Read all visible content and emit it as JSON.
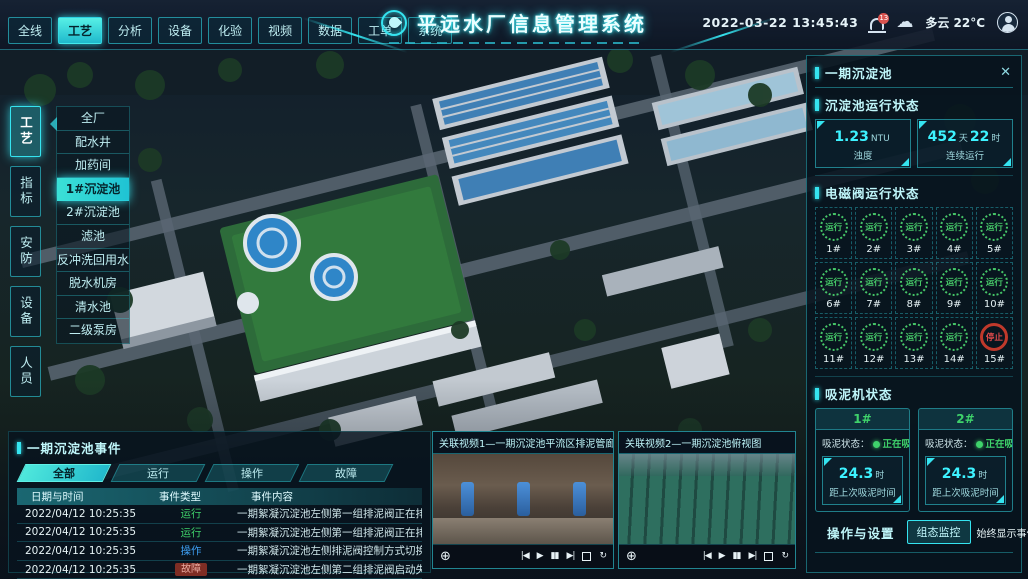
{
  "app": {
    "title": "平远水厂信息管理系统"
  },
  "header": {
    "tabs": [
      {
        "label": "全线",
        "active": false
      },
      {
        "label": "工艺",
        "active": true
      },
      {
        "label": "分析",
        "active": false
      },
      {
        "label": "设备",
        "active": false
      },
      {
        "label": "化验",
        "active": false
      },
      {
        "label": "视频",
        "active": false
      },
      {
        "label": "数据",
        "active": false
      },
      {
        "label": "工单",
        "active": false
      },
      {
        "label": "系统",
        "active": false
      }
    ],
    "datetime": "2022-03-22 13:45:43",
    "notif_count": "13",
    "cloud_icon": "☁",
    "weather": "多云 22°C"
  },
  "side_tabs": [
    {
      "label": "工艺",
      "active": true
    },
    {
      "label": "指标",
      "active": false
    },
    {
      "label": "安防",
      "active": false
    },
    {
      "label": "设备",
      "active": false
    },
    {
      "label": "人员",
      "active": false
    }
  ],
  "process_menu": [
    {
      "label": "全厂",
      "active": false
    },
    {
      "label": "配水井",
      "active": false
    },
    {
      "label": "加药间",
      "active": false
    },
    {
      "label": "1#沉淀池",
      "active": true
    },
    {
      "label": "2#沉淀池",
      "active": false
    },
    {
      "label": "滤池",
      "active": false
    },
    {
      "label": "反冲洗回用水池",
      "active": false
    },
    {
      "label": "脱水机房",
      "active": false
    },
    {
      "label": "清水池",
      "active": false
    },
    {
      "label": "二级泵房",
      "active": false
    }
  ],
  "right_panel": {
    "title": "一期沉淀池",
    "close_icon": "✕",
    "run_status": {
      "title": "沉淀池运行状态",
      "stats": [
        {
          "parts": [
            [
              "1.23",
              "num"
            ],
            [
              "NTU",
              "unit"
            ]
          ],
          "label": "浊度"
        },
        {
          "parts": [
            [
              "452",
              "num"
            ],
            [
              "天",
              "unit"
            ],
            [
              "22",
              "num"
            ],
            [
              "时",
              "unit"
            ]
          ],
          "label": "连续运行"
        }
      ]
    },
    "valves": {
      "title": "电磁阀运行状态",
      "items": [
        {
          "id": "1#",
          "status": "运行",
          "state": "run"
        },
        {
          "id": "2#",
          "status": "运行",
          "state": "run"
        },
        {
          "id": "3#",
          "status": "运行",
          "state": "run"
        },
        {
          "id": "4#",
          "status": "运行",
          "state": "run"
        },
        {
          "id": "5#",
          "status": "运行",
          "state": "run"
        },
        {
          "id": "6#",
          "status": "运行",
          "state": "run"
        },
        {
          "id": "7#",
          "status": "运行",
          "state": "run"
        },
        {
          "id": "8#",
          "status": "运行",
          "state": "run"
        },
        {
          "id": "9#",
          "status": "运行",
          "state": "run"
        },
        {
          "id": "10#",
          "status": "运行",
          "state": "run"
        },
        {
          "id": "11#",
          "status": "运行",
          "state": "run"
        },
        {
          "id": "12#",
          "status": "运行",
          "state": "run"
        },
        {
          "id": "13#",
          "status": "运行",
          "state": "run"
        },
        {
          "id": "14#",
          "status": "运行",
          "state": "run"
        },
        {
          "id": "15#",
          "status": "停止",
          "state": "stop"
        }
      ]
    },
    "suckers": {
      "title": "吸泥机状态",
      "status_label": "吸泥状态：",
      "cards": [
        {
          "id": "1#",
          "status": "正在吸泥",
          "stat": {
            "parts": [
              [
                "24.3",
                "num"
              ],
              [
                "时",
                "unit"
              ]
            ],
            "label": "距上次吸泥时间"
          }
        },
        {
          "id": "2#",
          "status": "正在吸泥",
          "stat": {
            "parts": [
              [
                "24.3",
                "num"
              ],
              [
                "时",
                "unit"
              ]
            ],
            "label": "距上次吸泥时间"
          }
        }
      ]
    },
    "ops": {
      "title": "操作与设置",
      "button": "组态监控",
      "toggle_label": "始终显示事件：",
      "toggle_on": true
    }
  },
  "events": {
    "title": "一期沉淀池事件",
    "tabs": [
      {
        "label": "全部",
        "active": true
      },
      {
        "label": "运行",
        "active": false
      },
      {
        "label": "操作",
        "active": false
      },
      {
        "label": "故障",
        "active": false
      }
    ],
    "columns": [
      "日期与时间",
      "事件类型",
      "事件内容"
    ],
    "rows": [
      {
        "time": "2022/04/12 10:25:35",
        "type": "运行",
        "kind": "run",
        "content": "一期絮凝沉淀池左侧第一组排泥阀正在排泥"
      },
      {
        "time": "2022/04/12 10:25:35",
        "type": "运行",
        "kind": "run",
        "content": "一期絮凝沉淀池左侧第一组排泥阀正在排泥"
      },
      {
        "time": "2022/04/12 10:25:35",
        "type": "操作",
        "kind": "op",
        "content": "一期絮凝沉淀池左侧排泥阀控制方式切换为手动"
      },
      {
        "time": "2022/04/12 10:25:35",
        "type": "故障",
        "kind": "fault",
        "content": "一期絮凝沉淀池左侧第二组排泥阀启动失败"
      }
    ]
  },
  "videos": [
    {
      "title": "关联视频1—一期沉淀池平流区排泥管廊"
    },
    {
      "title": "关联视频2—一期沉淀池俯视图"
    }
  ],
  "video_icons": {
    "dpad": "⊕",
    "prev": "|◀",
    "play": "▶",
    "pause": "▮▮",
    "next": "▶|",
    "loop": "↻"
  },
  "colors": {
    "accent": "#35e4f0",
    "value": "#3df2ff",
    "run": "#3fd36b",
    "fault": "#e14b4b",
    "op": "#3d9df0"
  }
}
